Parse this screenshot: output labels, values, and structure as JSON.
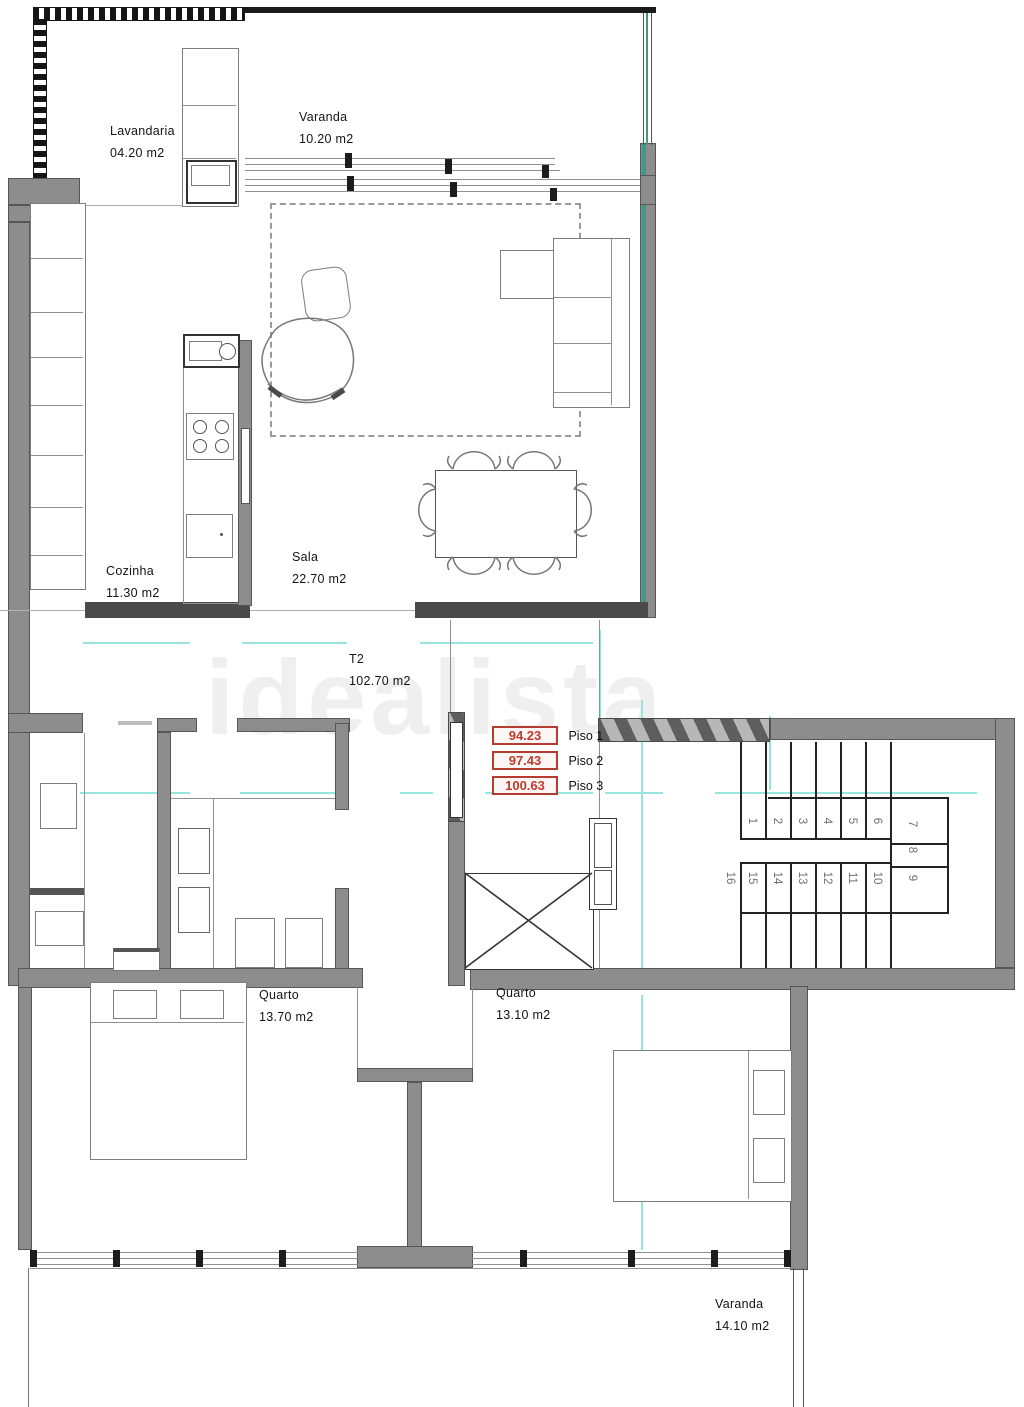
{
  "plan": {
    "unit_label": {
      "name": "T2",
      "area": "102.70 m2"
    },
    "rooms": [
      {
        "id": "lavandaria",
        "name": "Lavandaria",
        "area": "04.20 m2"
      },
      {
        "id": "varanda-top",
        "name": "Varanda",
        "area": "10.20 m2"
      },
      {
        "id": "cozinha",
        "name": "Cozinha",
        "area": "11.30 m2"
      },
      {
        "id": "sala",
        "name": "Sala",
        "area": "22.70 m2"
      },
      {
        "id": "quarto-left",
        "name": "Quarto",
        "area": "13.70 m2"
      },
      {
        "id": "quarto-right",
        "name": "Quarto",
        "area": "13.10 m2"
      },
      {
        "id": "varanda-bottom",
        "name": "Varanda",
        "area": "14.10 m2"
      }
    ],
    "levels": [
      {
        "value": "94.23",
        "label": "Piso 1"
      },
      {
        "value": "97.43",
        "label": "Piso 2"
      },
      {
        "value": "100.63",
        "label": "Piso 3"
      }
    ],
    "stairs": {
      "steps": [
        "1",
        "2",
        "3",
        "4",
        "5",
        "6",
        "7",
        "8",
        "9",
        "10",
        "11",
        "12",
        "13",
        "14",
        "15",
        "16"
      ]
    },
    "watermark": "idealista",
    "colors": {
      "wall_gray": "#8d8d8d",
      "line_black": "#1b1b1b",
      "guide_cyan": "#98e4de",
      "glass_teal": "#3f9a8b",
      "level_red": "#b43c30",
      "step_number_gray": "#6f6f6f"
    }
  }
}
